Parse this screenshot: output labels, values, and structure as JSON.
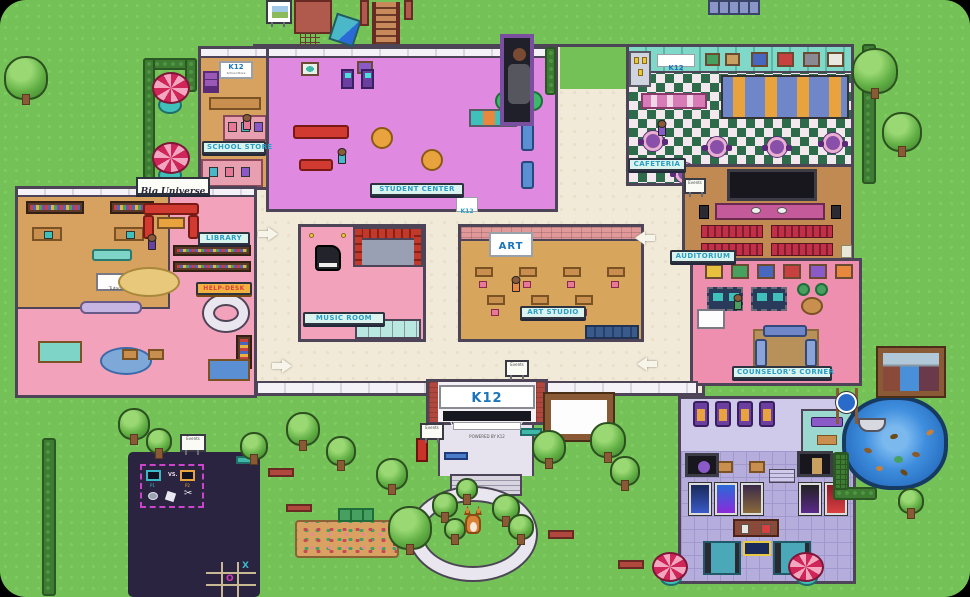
{
  "scene": {
    "name": "K12 Virtual Academy campus map"
  },
  "signs": {
    "school_store": "SCHOOL STORE",
    "student_center": "STUDENT CENTER",
    "library": "LIBRARY",
    "music_room": "MUSIC ROOM",
    "art_studio": "ART STUDIO",
    "cafeteria": "CAFETERIA",
    "auditorium": "AUDITORIUM",
    "counselors_corner": "COUNSELOR'S CORNER",
    "help_desk": "HELP-DESK",
    "big_universe": "Big Universe",
    "tutoring": "Tutoring",
    "art_wall": "ART",
    "events": "Events",
    "k12_logo": "K12",
    "store_wall_sub": "School Store"
  },
  "entrance": {
    "logo": "K12",
    "title": "VIRTUAL ACADEMY",
    "subtitle": "POWERED BY K12"
  },
  "game_mat": {
    "p1": "P1",
    "vs": "VS.",
    "p2": "P2",
    "x": "X",
    "o": "O"
  },
  "colors": {
    "grass": "#74c257",
    "hallway_floor": "#f2ead8",
    "student_center_floor": "#e089e0",
    "store_floor": "#d7a160",
    "library_floor": "#f2a2ba",
    "art_floor": "#d8a55c",
    "auditorium_floor": "#c18a52",
    "cafeteria_green": "#2e6b4b",
    "counselor_floor": "#ef8fb0",
    "theater_floor": "#b5addc",
    "pond_water": "#2d7fd0",
    "game_mat_bg": "#2a2440",
    "plaque_text": "#2a9fc4",
    "k12_blue": "#1b75bb"
  }
}
